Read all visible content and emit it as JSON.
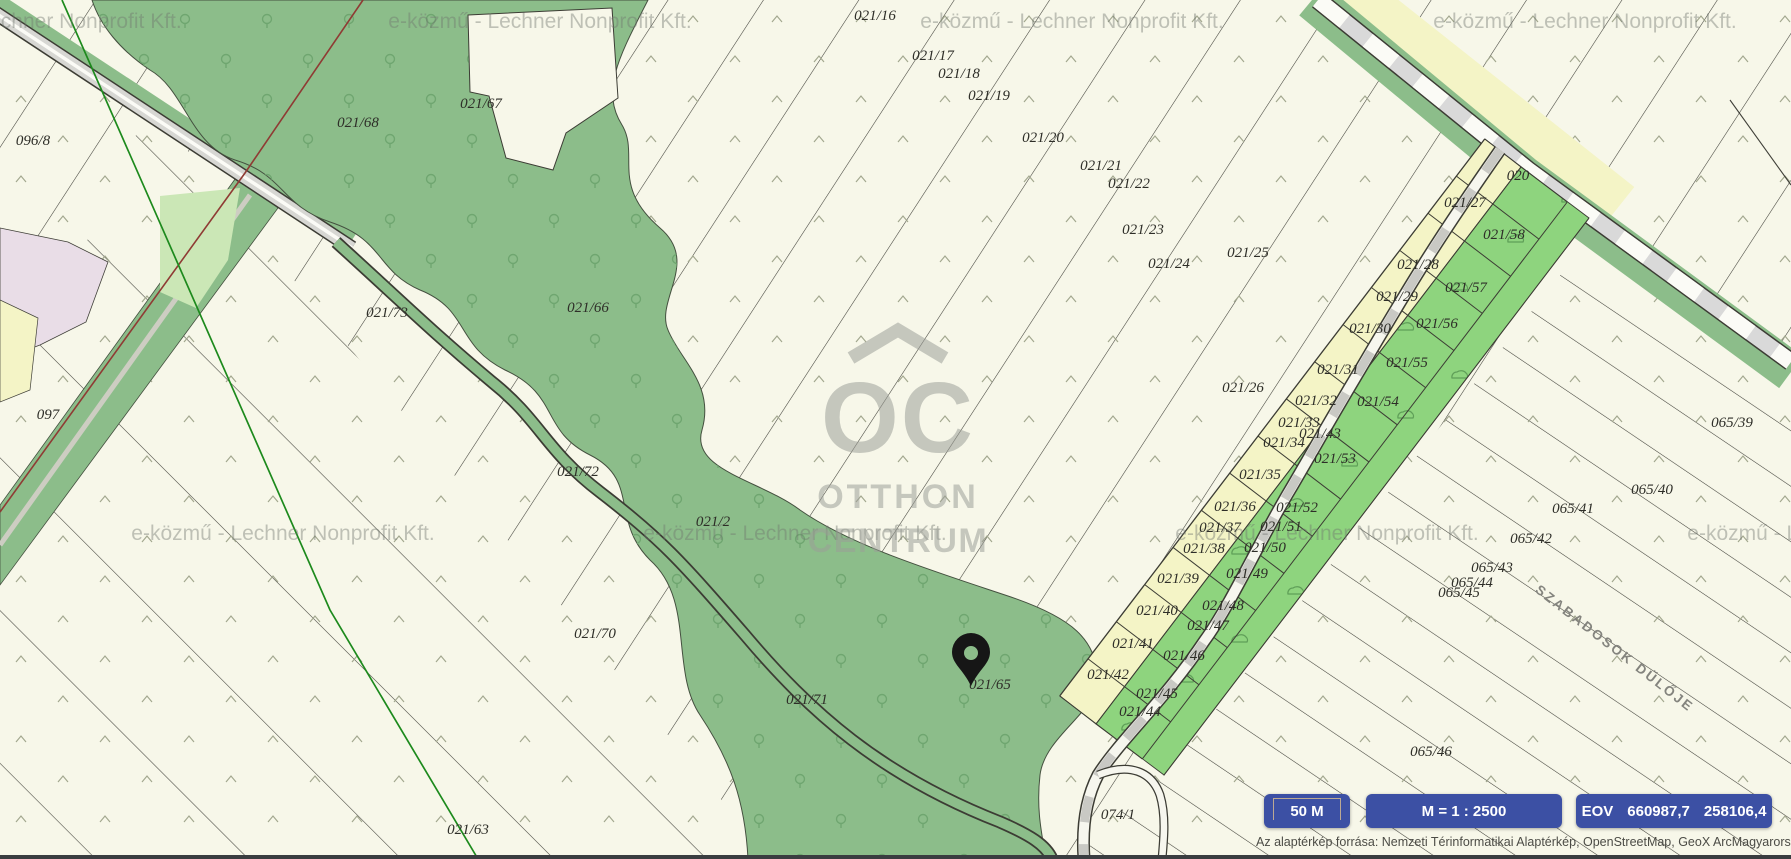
{
  "map": {
    "watermark_text": "e-közmű - Lechner Nonprofit Kft.",
    "street_label": "SZABADOSOK DŰLŐJE",
    "logo": {
      "monogram": "OC",
      "line1": "OTTHON",
      "line2": "CENTRUM"
    },
    "parcels": [
      {
        "label": "021/16",
        "x": 875,
        "y": 20
      },
      {
        "label": "021/17",
        "x": 933,
        "y": 60
      },
      {
        "label": "021/18",
        "x": 959,
        "y": 78
      },
      {
        "label": "021/19",
        "x": 989,
        "y": 100
      },
      {
        "label": "021/20",
        "x": 1043,
        "y": 142
      },
      {
        "label": "021/21",
        "x": 1101,
        "y": 170
      },
      {
        "label": "021/22",
        "x": 1129,
        "y": 188
      },
      {
        "label": "021/23",
        "x": 1143,
        "y": 234
      },
      {
        "label": "021/24",
        "x": 1169,
        "y": 268
      },
      {
        "label": "021/25",
        "x": 1248,
        "y": 257
      },
      {
        "label": "021/26",
        "x": 1243,
        "y": 392
      },
      {
        "label": "021/27",
        "x": 1465,
        "y": 207
      },
      {
        "label": "021/28",
        "x": 1418,
        "y": 269
      },
      {
        "label": "021/29",
        "x": 1397,
        "y": 301
      },
      {
        "label": "021/30",
        "x": 1370,
        "y": 333
      },
      {
        "label": "021/31",
        "x": 1338,
        "y": 374
      },
      {
        "label": "021/32",
        "x": 1316,
        "y": 405
      },
      {
        "label": "021/33",
        "x": 1299,
        "y": 427
      },
      {
        "label": "021/34",
        "x": 1284,
        "y": 447
      },
      {
        "label": "021/35",
        "x": 1260,
        "y": 479
      },
      {
        "label": "021/36",
        "x": 1235,
        "y": 511
      },
      {
        "label": "021/37",
        "x": 1220,
        "y": 532
      },
      {
        "label": "021/38",
        "x": 1204,
        "y": 553
      },
      {
        "label": "021/39",
        "x": 1178,
        "y": 583
      },
      {
        "label": "021/40",
        "x": 1157,
        "y": 615
      },
      {
        "label": "021/41",
        "x": 1133,
        "y": 648
      },
      {
        "label": "021/42",
        "x": 1108,
        "y": 679
      },
      {
        "label": "021/43",
        "x": 1320,
        "y": 438
      },
      {
        "label": "021/44",
        "x": 1140,
        "y": 716
      },
      {
        "label": "021/45",
        "x": 1157,
        "y": 698
      },
      {
        "label": "021/46",
        "x": 1184,
        "y": 660
      },
      {
        "label": "021/47",
        "x": 1208,
        "y": 630
      },
      {
        "label": "021/48",
        "x": 1223,
        "y": 610
      },
      {
        "label": "021/49",
        "x": 1247,
        "y": 578
      },
      {
        "label": "021/50",
        "x": 1265,
        "y": 552
      },
      {
        "label": "021/51",
        "x": 1281,
        "y": 531
      },
      {
        "label": "021/52",
        "x": 1297,
        "y": 512
      },
      {
        "label": "021/53",
        "x": 1335,
        "y": 463
      },
      {
        "label": "021/54",
        "x": 1378,
        "y": 406
      },
      {
        "label": "021/55",
        "x": 1407,
        "y": 367
      },
      {
        "label": "021/56",
        "x": 1437,
        "y": 328
      },
      {
        "label": "021/57",
        "x": 1466,
        "y": 292
      },
      {
        "label": "021/58",
        "x": 1504,
        "y": 239
      },
      {
        "label": "020",
        "x": 1518,
        "y": 180
      },
      {
        "label": "021/2",
        "x": 713,
        "y": 526
      },
      {
        "label": "021/63",
        "x": 468,
        "y": 834
      },
      {
        "label": "021/65",
        "x": 990,
        "y": 689
      },
      {
        "label": "021/66",
        "x": 588,
        "y": 312
      },
      {
        "label": "021/67",
        "x": 481,
        "y": 108
      },
      {
        "label": "021/68",
        "x": 358,
        "y": 127
      },
      {
        "label": "021/70",
        "x": 595,
        "y": 638
      },
      {
        "label": "021/71",
        "x": 807,
        "y": 704
      },
      {
        "label": "021/72",
        "x": 578,
        "y": 476
      },
      {
        "label": "021/73",
        "x": 387,
        "y": 317
      },
      {
        "label": "096/8",
        "x": 33,
        "y": 145
      },
      {
        "label": "097",
        "x": 48,
        "y": 419
      },
      {
        "label": "074/1",
        "x": 1118,
        "y": 819
      },
      {
        "label": "065/39",
        "x": 1732,
        "y": 427
      },
      {
        "label": "065/40",
        "x": 1652,
        "y": 494
      },
      {
        "label": "065/41",
        "x": 1573,
        "y": 513
      },
      {
        "label": "065/42",
        "x": 1531,
        "y": 543
      },
      {
        "label": "065/43",
        "x": 1492,
        "y": 572
      },
      {
        "label": "065/44",
        "x": 1472,
        "y": 587
      },
      {
        "label": "065/45",
        "x": 1459,
        "y": 597
      },
      {
        "label": "065/46",
        "x": 1431,
        "y": 756
      }
    ]
  },
  "controls": {
    "scale_bar_label": "50 M",
    "scale_ratio": "M = 1 : 2500",
    "coords": {
      "system": "EOV",
      "x": "660987,7",
      "y": "258106,4"
    }
  },
  "attribution": "Az alaptérkép forrása: Nemzeti Térinformatikai Alaptérkép, OpenStreetMap, GeoX ArcMagyarorsz",
  "colors": {
    "accent_blue": "#3c50a4",
    "map_cream": "#f7f7e9",
    "forest_green": "#8cbd8a",
    "strip_green": "#8ed47e",
    "parcel_yellow": "#f4f4c6",
    "pink_area": "#e9dde7",
    "red_line": "#8f3b34",
    "green_line": "#1d8a1d"
  }
}
